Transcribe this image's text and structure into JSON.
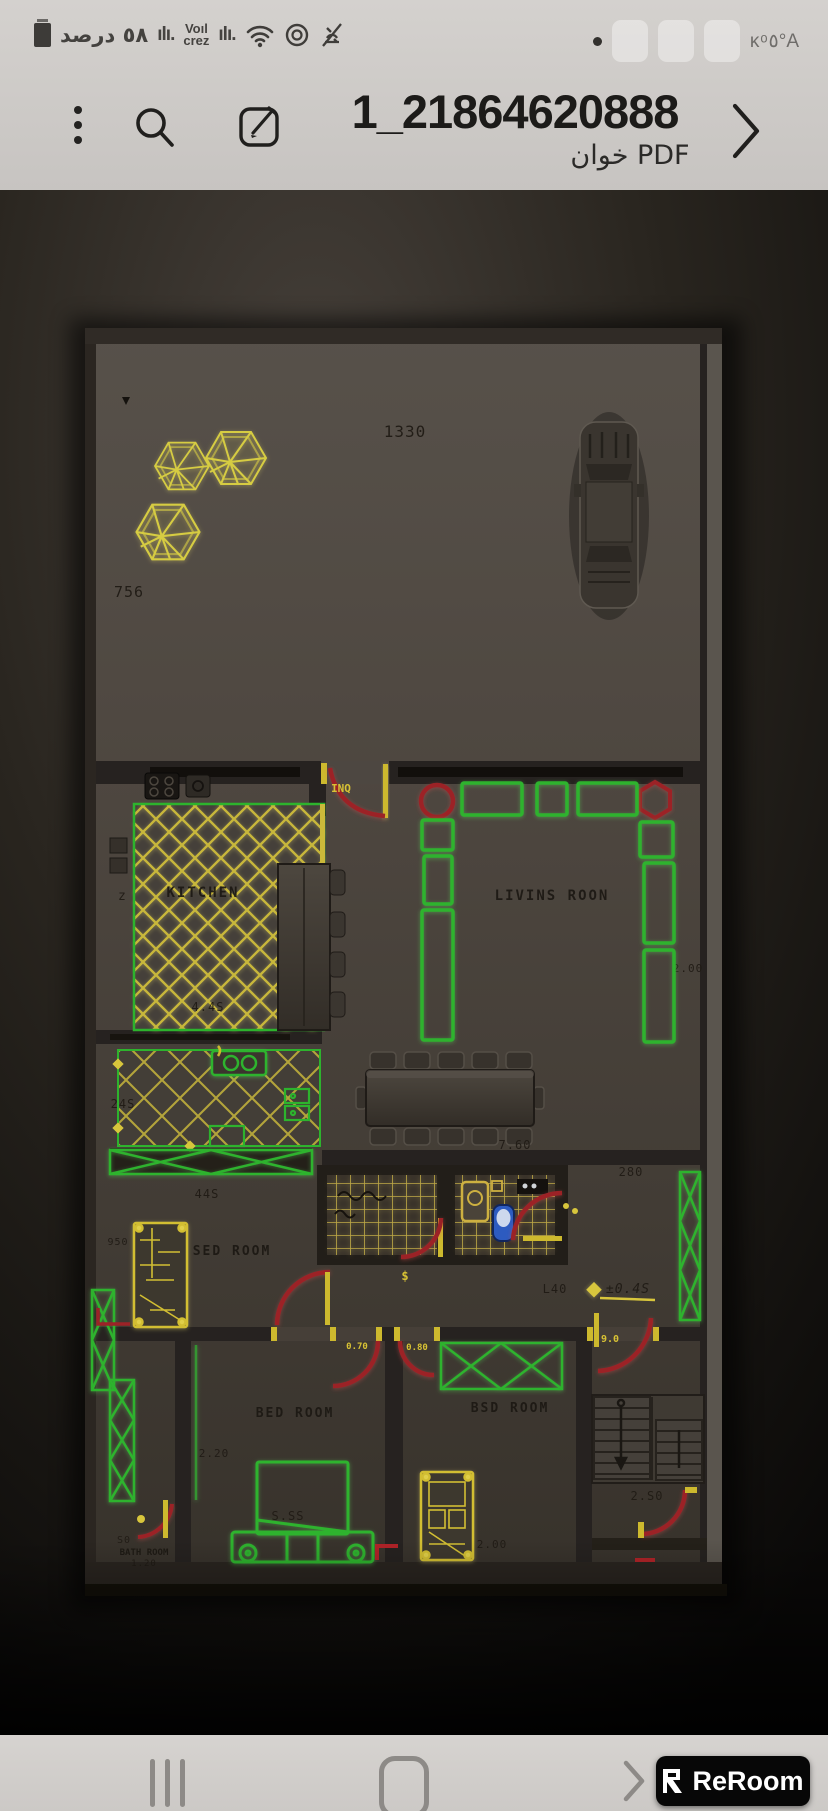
{
  "status_bar": {
    "battery_text": "٥٨ درصد",
    "signal_left": "ılı.",
    "carrier_line1": "Voıl",
    "carrier_line2": "crez",
    "signal_right": "ılı.",
    "right_text": "ᴋᵒ٥°A"
  },
  "header": {
    "title": "1_21864620888",
    "subtitle": "خوان PDF"
  },
  "plan": {
    "courtyard": {
      "width_dim": "1330",
      "side_dim": "756"
    },
    "entry_label": "INQ",
    "kitchen": {
      "name": "KITCHEN",
      "width_dim": "4.4S",
      "zigzag_mark": "z"
    },
    "utility": {
      "width_dim": "24S"
    },
    "living": {
      "name": "LIVINS ROON",
      "right_dim": "2.00"
    },
    "dining": {
      "width_dim": "7.60"
    },
    "corridor": {
      "top_dim": "280",
      "hall_dim": "44S",
      "left_dim": "L40",
      "level_mark": "±0.4S",
      "door_mark": "$"
    },
    "doors": {
      "labels": [
        "0.70",
        "0.80",
        "9.0"
      ]
    },
    "bedroom1": {
      "name": "SED ROOM",
      "side_dim": "950"
    },
    "bedroom2": {
      "name": "BED ROOM",
      "width_dim": "2.20",
      "bed_dim": "S.SS"
    },
    "bedroom3": {
      "name": "BSD ROOM",
      "wardrobe_dim": "2.00"
    },
    "bathroom_small": {
      "line1": "S0",
      "line2": "BATH ROOM",
      "line3": "1.20"
    },
    "stairs": {
      "width_dim": "2.S0"
    },
    "colors": {
      "furniture_green": "#2db32d",
      "cad_yellow": "#d2c03a",
      "door_red": "#9c2227",
      "toilet_blue": "#2d5bc0"
    }
  },
  "navbar": {
    "watermark": "ReRoom"
  }
}
